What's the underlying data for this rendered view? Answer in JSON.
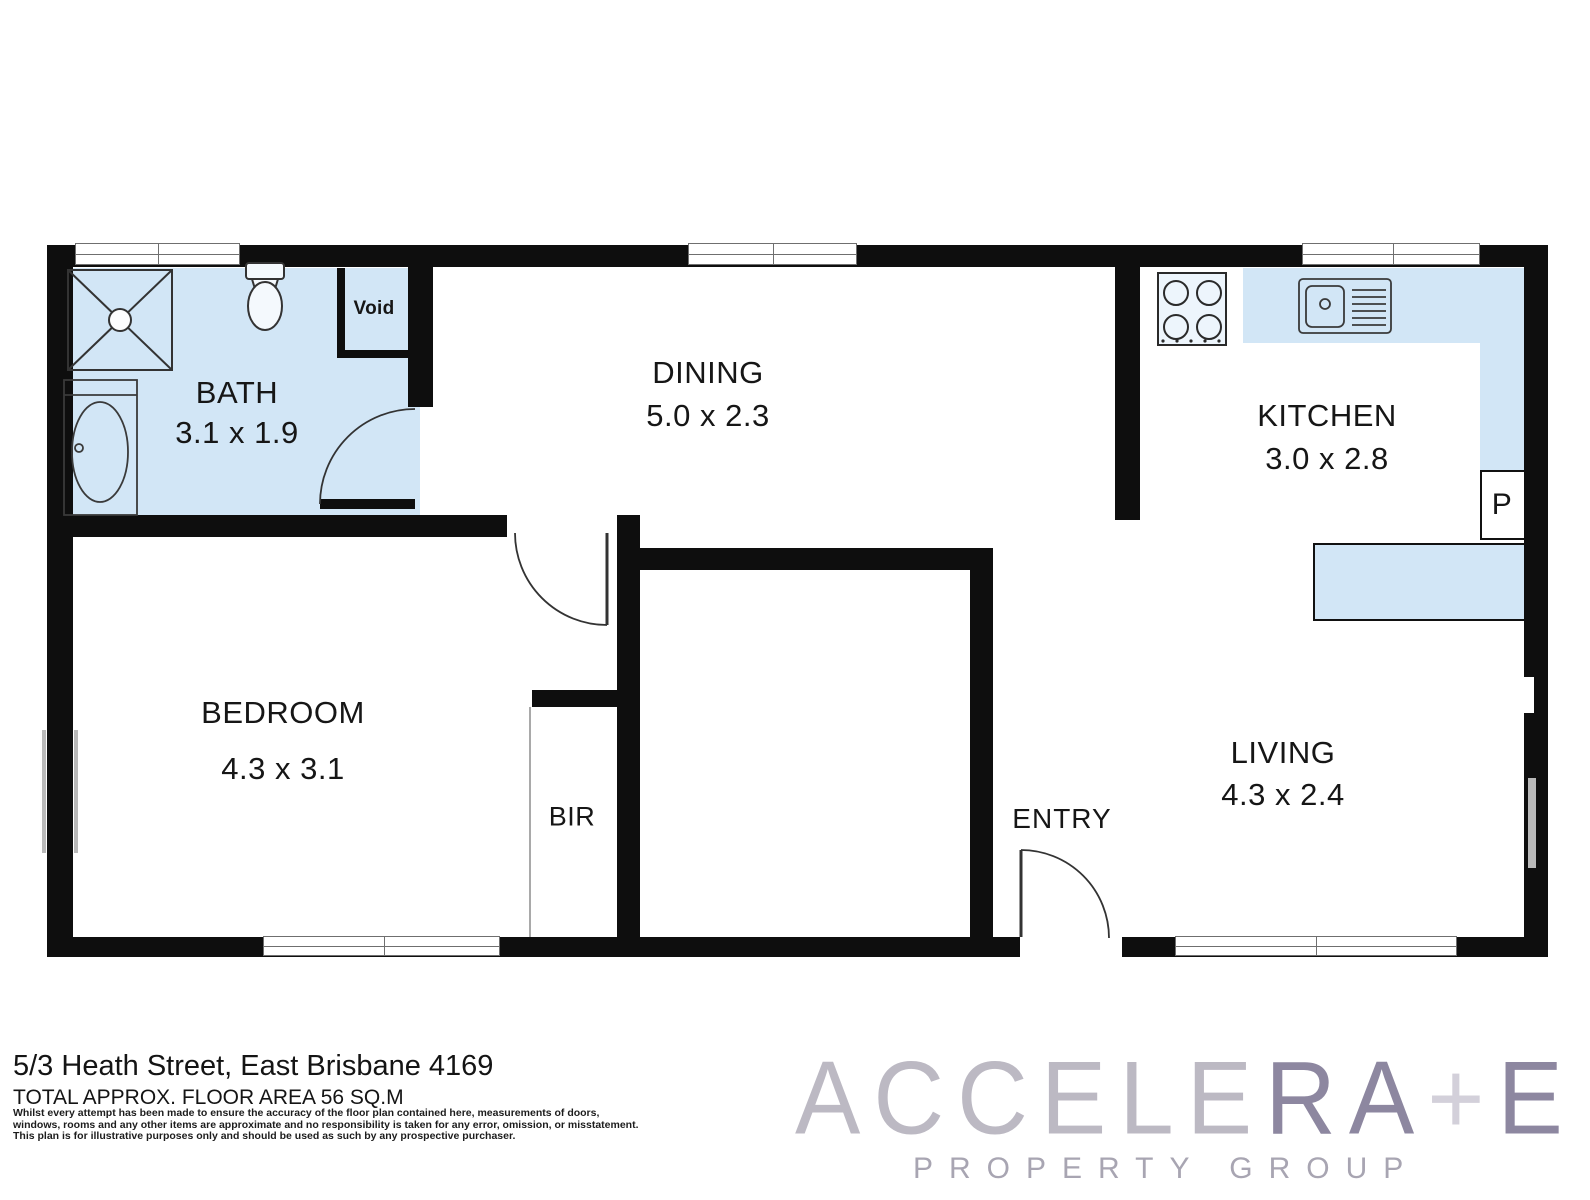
{
  "title": "Floor plan - 5/3 Heath Street, East Brisbane 4169",
  "plan": {
    "rooms": [
      {
        "id": "bath",
        "label": "BATH",
        "dims": "3.1 x 1.9"
      },
      {
        "id": "dining",
        "label": "DINING",
        "dims": "5.0 x 2.3"
      },
      {
        "id": "kitchen",
        "label": "KITCHEN",
        "dims": "3.0 x 2.8"
      },
      {
        "id": "bedroom",
        "label": "BEDROOM",
        "dims": "4.3 x 3.1"
      },
      {
        "id": "living",
        "label": "LIVING",
        "dims": "4.3 x 2.4"
      },
      {
        "id": "entry",
        "label": "ENTRY",
        "dims": ""
      },
      {
        "id": "bir",
        "label": "BIR",
        "dims": ""
      },
      {
        "id": "void",
        "label": "Void",
        "dims": ""
      },
      {
        "id": "pantry",
        "label": "P",
        "dims": ""
      }
    ],
    "fixtures": [
      "shower",
      "toilet",
      "bathtub",
      "kitchen-sink",
      "cooktop",
      "kitchen-bench",
      "island-bench",
      "built-in-robe"
    ],
    "colors": {
      "wet_area_fill": "#d2e6f6",
      "wall": "#0e0e0e",
      "fixture_outline": "#333333"
    }
  },
  "footer": {
    "address": "5/3 Heath Street, East Brisbane 4169",
    "area": "TOTAL APPROX. FLOOR AREA 56 SQ.M",
    "disclaimer_lines": [
      "Whilst every attempt has been made to ensure the accuracy of the floor plan contained here, measurements of doors,",
      "windows, rooms and any other items are approximate and no responsibility is taken for any error, omission, or misstatement.",
      "This plan is for illustrative purposes only and should be used as such by any prospective purchaser."
    ]
  },
  "logo": {
    "word_part1": "ACCELE",
    "word_part2": "RA",
    "word_part3": "+",
    "word_part4": "E",
    "tagline": "PROPERTY GROUP",
    "colors": {
      "thin": "#bcb9c3",
      "accent": "#8d87a0",
      "plus": "#d3d0da",
      "tagline": "#a8a5b2"
    }
  }
}
